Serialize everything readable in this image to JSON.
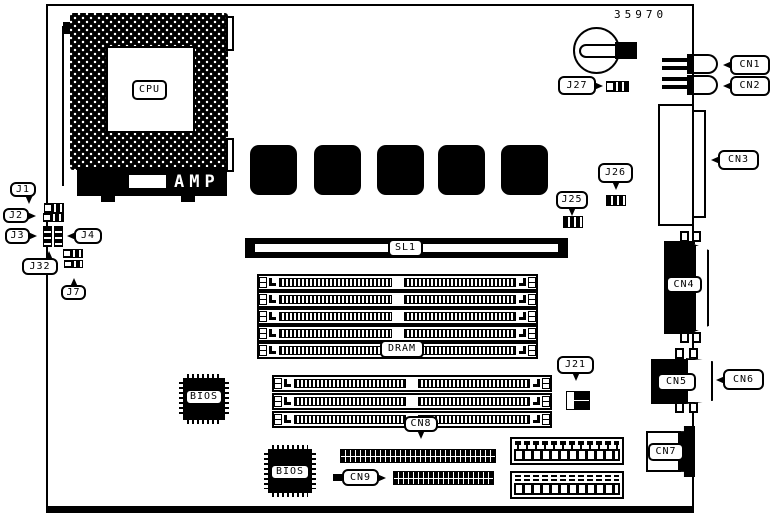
{
  "diagram": {
    "part_number": "35970",
    "cpu": {
      "label": "CPU",
      "brand": "AMP"
    },
    "sl1_label": "SL1",
    "dram_label": "DRAM",
    "bios_label": "BIOS",
    "jumpers": {
      "j1": "J1",
      "j2": "J2",
      "j3": "J3",
      "j4": "J4",
      "j7": "J7",
      "j21": "J21",
      "j25": "J25",
      "j26": "J26",
      "j27": "J27",
      "j32": "J32"
    },
    "connectors": {
      "cn1": "CN1",
      "cn2": "CN2",
      "cn3": "CN3",
      "cn4": "CN4",
      "cn5": "CN5",
      "cn6": "CN6",
      "cn7": "CN7",
      "cn8": "CN8",
      "cn9": "CN9"
    }
  }
}
